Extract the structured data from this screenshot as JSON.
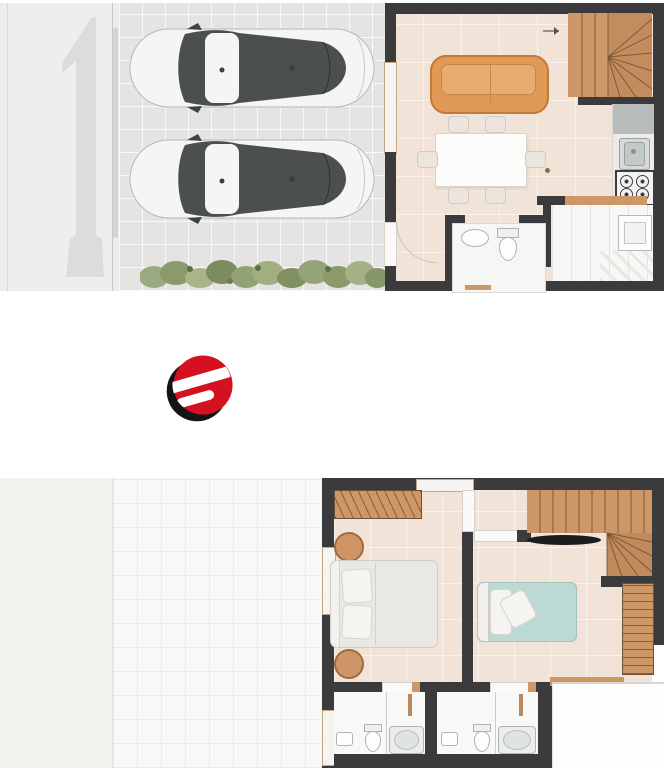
{
  "document": {
    "type": "architectural-floor-plan-sheet",
    "visible_text": "none",
    "background": "#ffffff"
  },
  "colors": {
    "wall": "#3b3b3d",
    "floor": "#f2e3d8",
    "wood": "#cd9768",
    "wood_dark": "#b97f55",
    "sofa": "#e09a56",
    "driveway": "#e4e4e2",
    "sidewalk": "#efeeec",
    "numeral_gray": "#dddcda",
    "car_body": "#f4f5f4",
    "car_glass": "#4c4f50",
    "hedge_green": "#8a9a6b",
    "teal": "#bcd9d3",
    "logo_red": "#d4121f",
    "logo_black": "#141414"
  },
  "ground_floor": {
    "driveway": {
      "cars": 2,
      "car_view": "top",
      "car_facing": "left",
      "hedge": true,
      "tile_grid": true
    },
    "rooms": [
      {
        "name": "living-dining",
        "furniture": [
          "sofa",
          "dining-table",
          "six-chairs"
        ]
      },
      {
        "name": "kitchen",
        "furniture": [
          "counter",
          "sink",
          "stove-4-burner"
        ]
      },
      {
        "name": "stairs",
        "style": "winder",
        "material": "wood"
      },
      {
        "name": "bathroom",
        "furniture": [
          "washbasin",
          "toilet"
        ]
      },
      {
        "name": "service-area",
        "furniture": [
          "laundry-tank"
        ]
      }
    ]
  },
  "logo": {
    "name": "brand-logo",
    "letter": "e",
    "style": "red-sphere-with-black-swoosh"
  },
  "upper_floor": {
    "rooms": [
      {
        "name": "bedroom-1",
        "furniture": [
          "double-bed",
          "wardrobe",
          "round-nightstand",
          "round-nightstand"
        ]
      },
      {
        "name": "bedroom-2",
        "furniture": [
          "single-bed-teal",
          "wall-tv",
          "closet"
        ]
      },
      {
        "name": "stairs",
        "style": "winder",
        "material": "wood"
      },
      {
        "name": "bathroom-1",
        "furniture": [
          "washbasin",
          "toilet",
          "shower"
        ]
      },
      {
        "name": "bathroom-2",
        "furniture": [
          "washbasin",
          "toilet",
          "shower"
        ]
      },
      {
        "name": "terrace",
        "furniture": []
      }
    ],
    "garage_roof": true
  }
}
